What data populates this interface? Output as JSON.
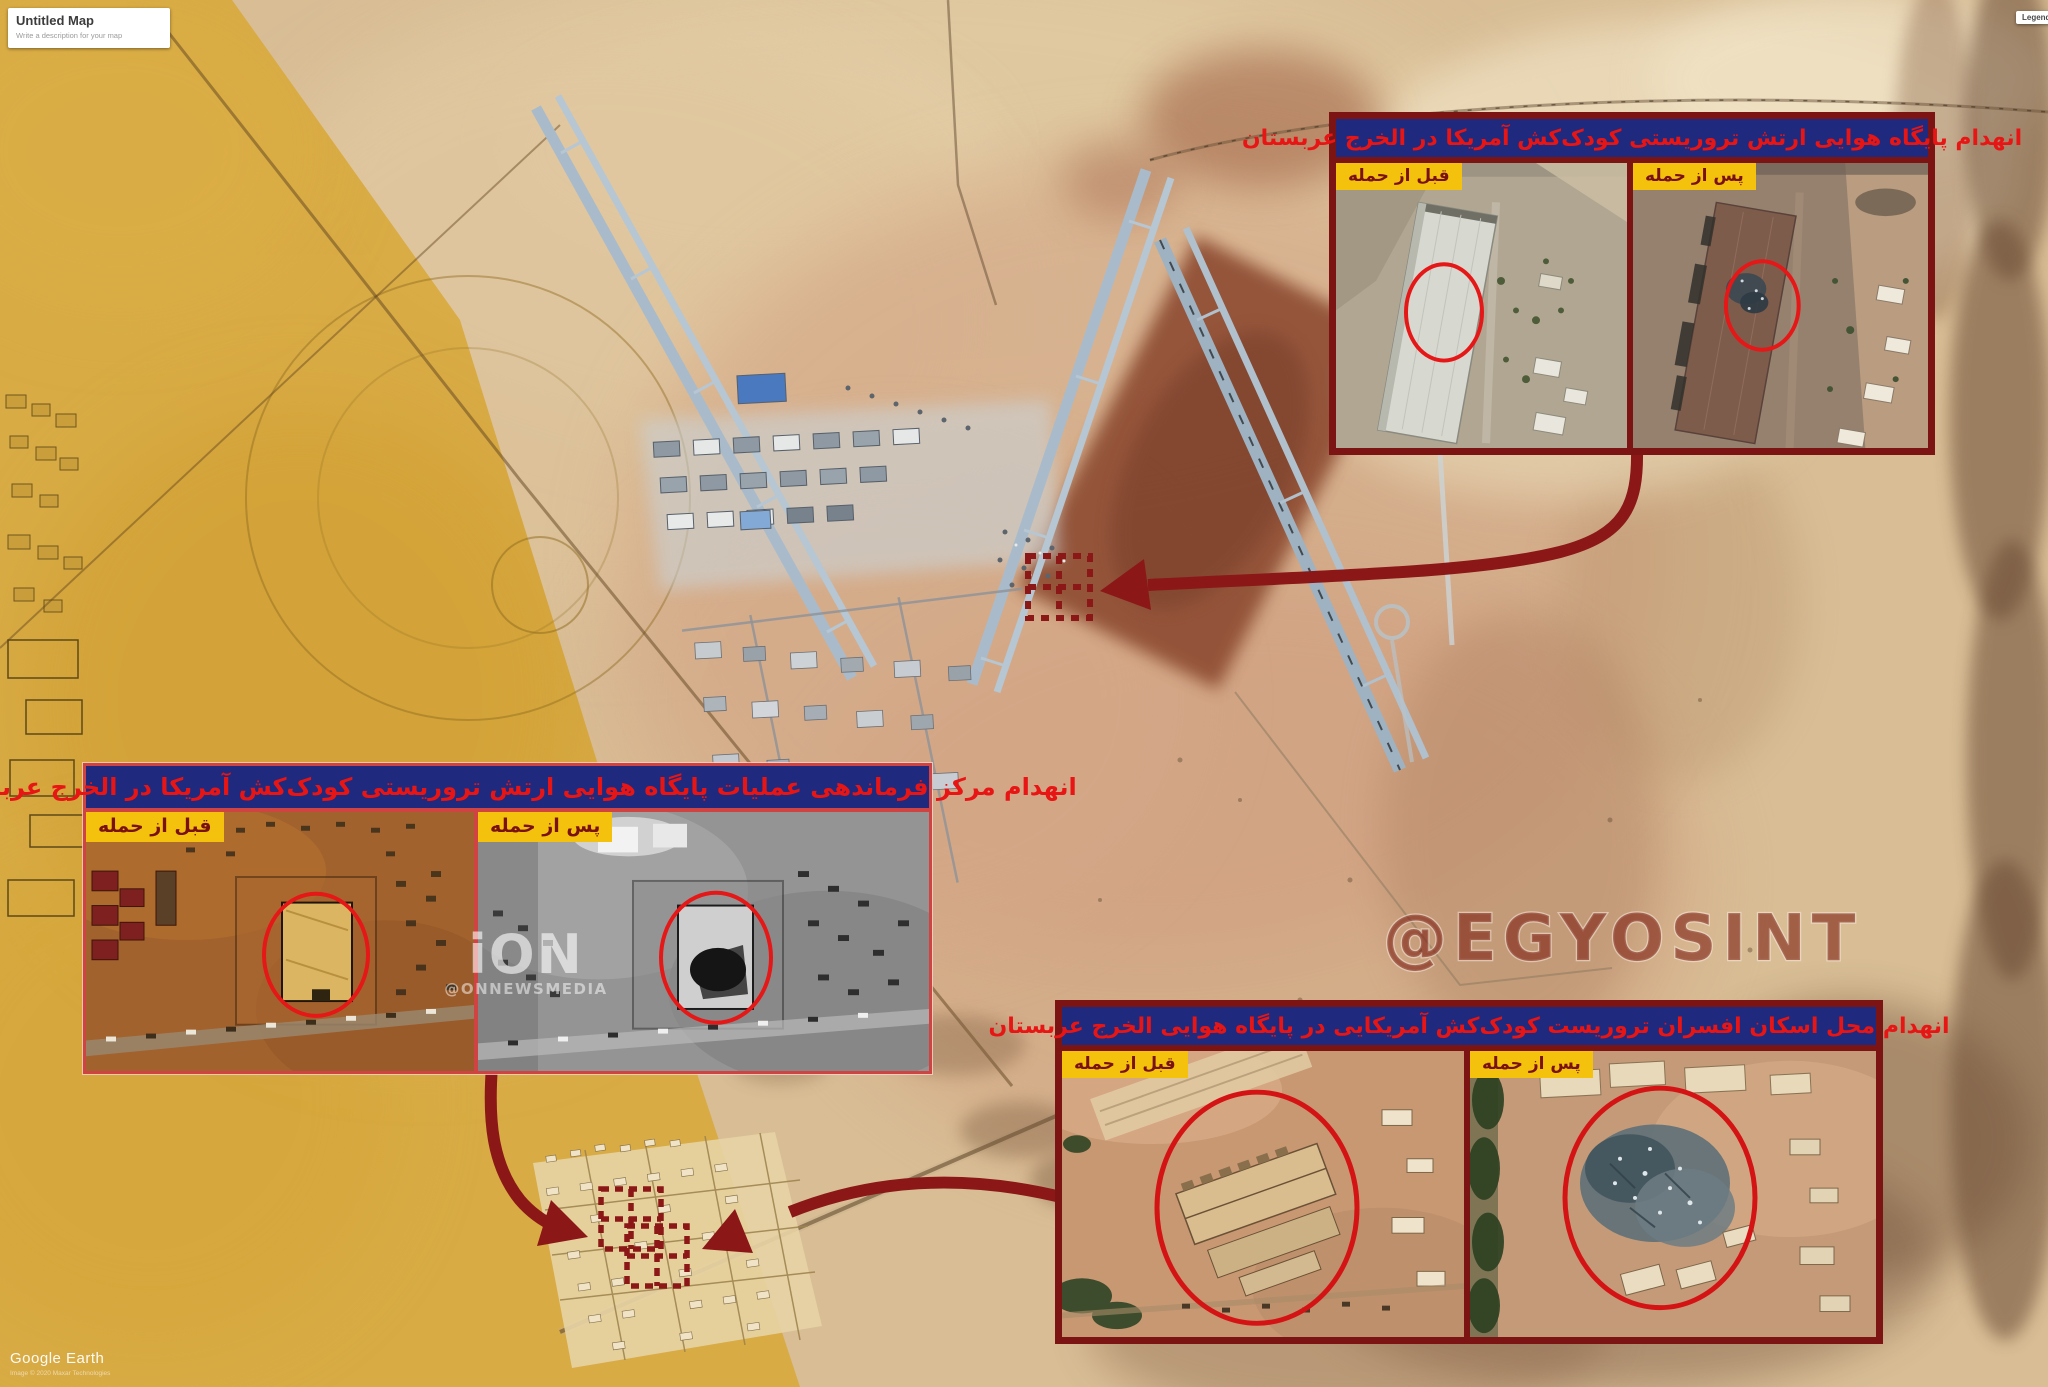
{
  "ui": {
    "untitled_card": {
      "title": "Untitled Map",
      "subtitle": "Write a description for your map"
    },
    "legend_button": "Legend",
    "google_earth": "Google Earth",
    "attribution": "Image © 2020 Maxar Technologies",
    "egyosint_watermark": "@EGYOSINT",
    "ion_logo": "iON",
    "ion_handle": "@ONNEWSMEDIA"
  },
  "insets": {
    "airbase": {
      "title": "انهدام پایگاه هوایی ارتش تروریستی کودک‌کش آمریکا در الخرج عربستان",
      "before_label": "قبل از حمله",
      "after_label": "پس از حمله"
    },
    "command_center": {
      "title": "انهدام مرکز فرماندهی عملیات پایگاه هوایی ارتش تروریستی کودک‌کش آمریکا در الخرج عربستان",
      "before_label": "قبل از حمله",
      "after_label": "پس از حمله"
    },
    "officers_housing": {
      "title": "انهدام محل اسکان افسران تروریست کودک‌کش آمریکایی در پایگاه هوایی الخرج عربستان",
      "before_label": "قبل از حمله",
      "after_label": "پس از حمله"
    }
  },
  "colors": {
    "annotation_red": "#8b1717",
    "inset_border_dark": "#7d1414",
    "inset_border_light": "#cf4343",
    "title_bar_navy": "#1f2a7e",
    "title_text_red": "#e81515",
    "label_yellow": "#f4c20d",
    "label_text_maroon": "#7a1111",
    "desert_tan": "#d8bd95",
    "desert_gold": "#d8a93c"
  }
}
